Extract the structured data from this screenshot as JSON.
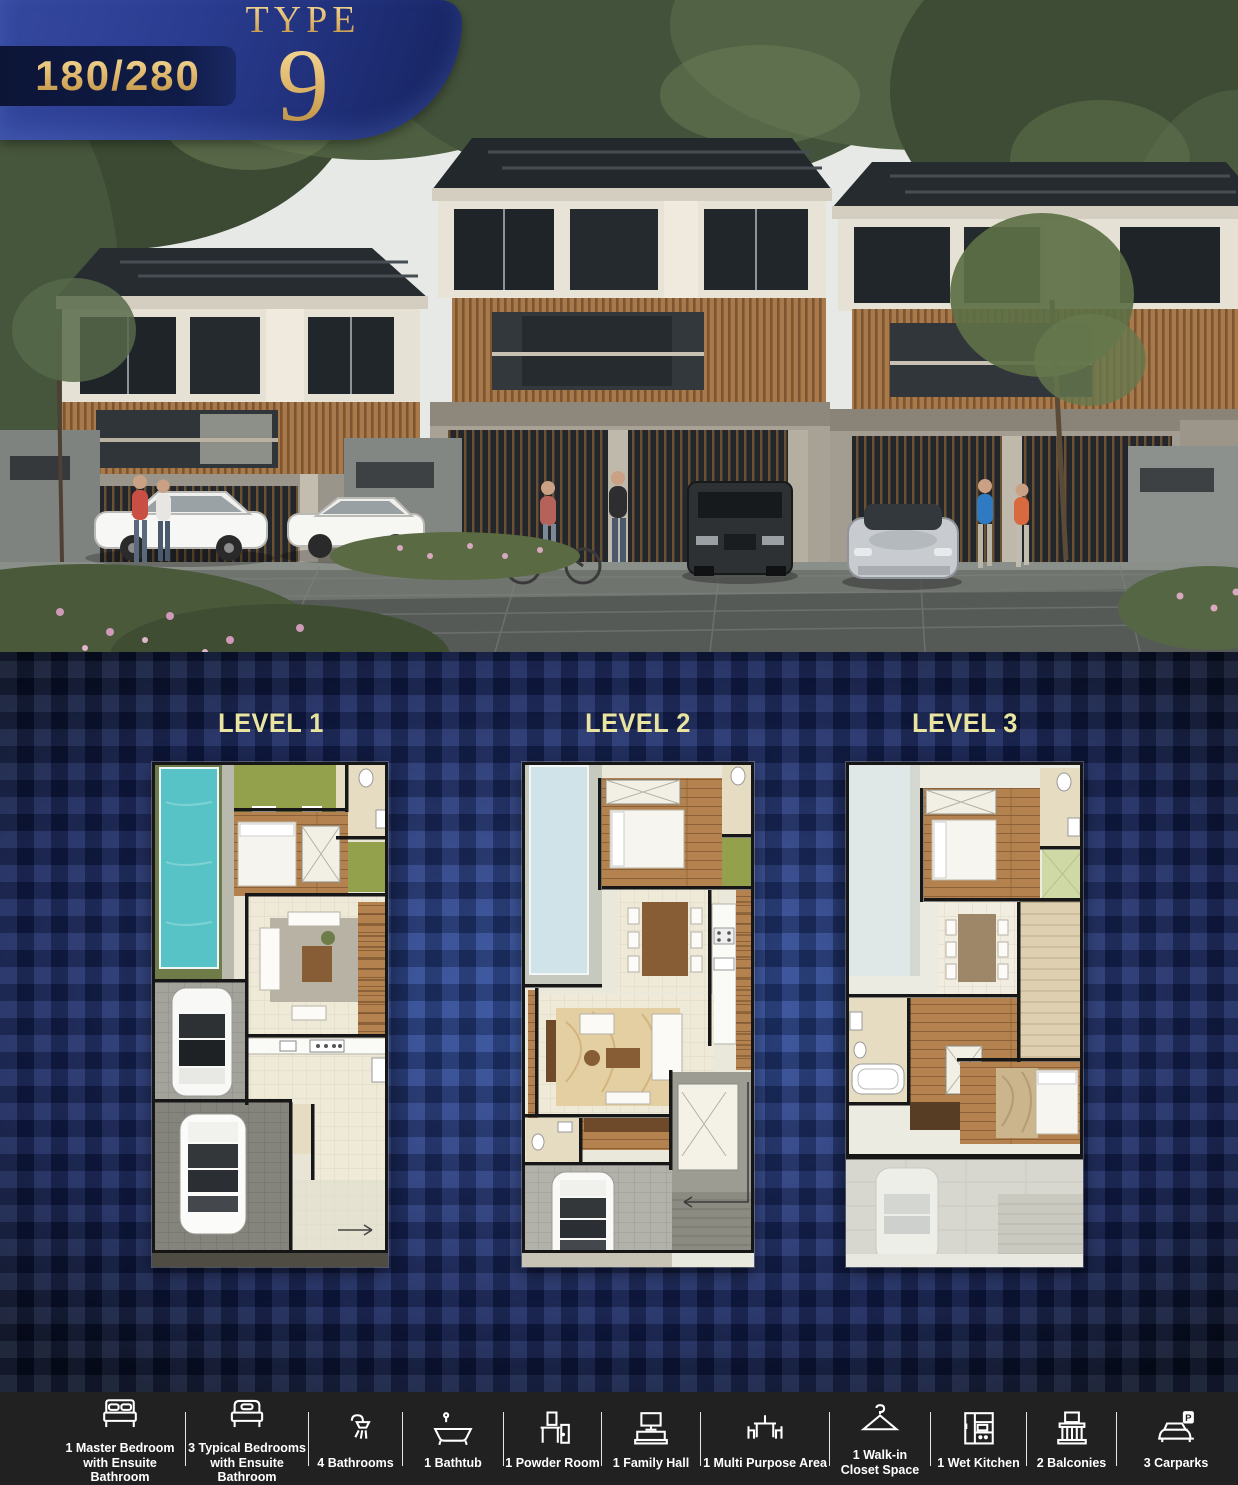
{
  "badge": {
    "area_ratio": "180/280",
    "type_label": "TYPE",
    "type_number": "9"
  },
  "levels": [
    {
      "label": "LEVEL 1"
    },
    {
      "label": "LEVEL 2"
    },
    {
      "label": "LEVEL 3"
    }
  ],
  "footer": {
    "items": [
      {
        "icon": "double-bed-icon",
        "label": "1 Master Bedroom with Ensuite Bathroom"
      },
      {
        "icon": "single-bed-icon",
        "label": "3 Typical Bedrooms with Ensuite Bathroom"
      },
      {
        "icon": "shower-icon",
        "label": "4 Bathrooms"
      },
      {
        "icon": "bathtub-icon",
        "label": "1 Bathtub"
      },
      {
        "icon": "powder-room-icon",
        "label": "1 Powder Room"
      },
      {
        "icon": "family-hall-icon",
        "label": "1 Family Hall"
      },
      {
        "icon": "multi-purpose-icon",
        "label": "1 Multi Purpose Area"
      },
      {
        "icon": "walk-in-closet-icon",
        "label": "1 Walk-in Closet Space"
      },
      {
        "icon": "wet-kitchen-icon",
        "label": "1 Wet Kitchen"
      },
      {
        "icon": "balcony-icon",
        "label": "2 Balconies"
      },
      {
        "icon": "carpark-icon",
        "label": "3 Carparks"
      }
    ],
    "carpark_sign": "P"
  },
  "colors": {
    "gold": "#d9b36a",
    "badge_blue": "#24367c",
    "ribbon_navy": "#101c48",
    "background_blue": "#24397f",
    "level_label_yellow": "#e9e5a0",
    "footer_bg": "#212121",
    "pool_teal": "#57c3c6",
    "pool_pale": "#cfe3e9",
    "wood": "#b3824f",
    "grass": "#93a04c"
  }
}
